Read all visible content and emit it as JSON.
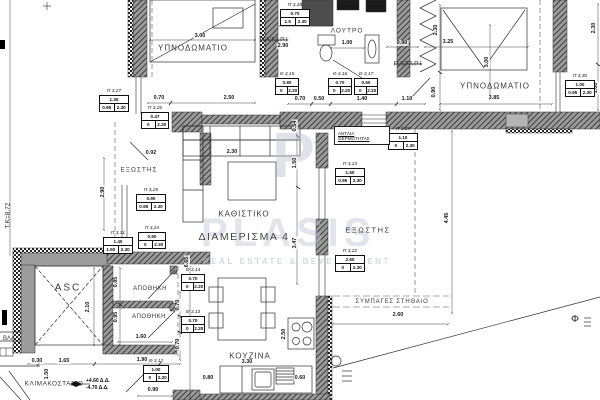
{
  "watermark": {
    "monogram": "P",
    "brand": "PLASIS",
    "tagline": "REAL ESTATE & DEVELOPMENT"
  },
  "unit": {
    "label": "ΔΙΑΜΕΡΙΣΜΑ 4"
  },
  "heatpump": {
    "line1": "ΑΝΤΛΙΑ",
    "line2": "ΘΕΡΜΟΤΗΤΑΣ"
  },
  "annotations": {
    "level": "Τ.Κ=8.72",
    "elev_up": "+4.60 Δ.Δ.",
    "elev_dn": "-4.70 Δ.Δ.",
    "phi": "Φ"
  },
  "labels": [
    {
      "t": "ΥΠΝΟΔΩΜΑΤΙΟ",
      "x": 193,
      "y": 48,
      "s": 8,
      "ls": 1
    },
    {
      "t": "ΥΠΝΟΔΩΜΑΤΙΟ",
      "x": 495,
      "y": 86,
      "s": 8,
      "ls": 1
    },
    {
      "t": "ΠΑΤΑΡΙ",
      "x": 274,
      "y": 40,
      "s": 6.5,
      "ls": 1,
      "strike": true
    },
    {
      "t": "ΠΑΤΑΡΙ",
      "x": 408,
      "y": 64,
      "s": 6.5,
      "ls": 1,
      "strike": true
    },
    {
      "t": "ΛΟΥΤΡΟ",
      "x": 347,
      "y": 31,
      "s": 6.5,
      "ls": 1
    },
    {
      "t": "ΚΑΘΙΣΤΙΚΟ",
      "x": 244,
      "y": 214,
      "s": 8,
      "ls": 1
    },
    {
      "t": "ΚΟΥΖΙΝΑ",
      "x": 250,
      "y": 356,
      "s": 8,
      "ls": 1
    },
    {
      "t": "ΕΞΩΣΤΗΣ",
      "x": 139,
      "y": 170,
      "s": 6.5,
      "ls": 1
    },
    {
      "t": "ΕΞΩΣΤΗΣ",
      "x": 368,
      "y": 230,
      "s": 7.5,
      "ls": 1.5
    },
    {
      "t": "ΑΠΟΘΗΚΗ",
      "x": 150,
      "y": 289,
      "s": 6,
      "ls": 0.5
    },
    {
      "t": "ΑΠΟΘΗΚΗ",
      "x": 149,
      "y": 317,
      "s": 6,
      "ls": 0.5
    },
    {
      "t": "ASC",
      "x": 68,
      "y": 288,
      "s": 10,
      "ls": 2
    },
    {
      "t": "ΚΛΙΜΑΚΟΣΤΑΣΙΟ",
      "x": 54,
      "y": 384,
      "s": 6.5,
      "ls": 0.5
    },
    {
      "t": "ΣΥΜΠΑΓΕΣ ΣΤΗΘΑΙΟ",
      "x": 392,
      "y": 302,
      "s": 6,
      "ls": 0.8
    },
    {
      "t": "ΒΛΑ",
      "x": 9,
      "y": 339,
      "s": 6,
      "ls": 0
    }
  ],
  "dims": [
    {
      "v": "3.00",
      "x": 200,
      "y": 36
    },
    {
      "v": "0.70",
      "x": 159,
      "y": 98
    },
    {
      "v": "2.50",
      "x": 229,
      "y": 98
    },
    {
      "v": "2.90",
      "x": 283,
      "y": 46
    },
    {
      "v": "1.00",
      "x": 347,
      "y": 43
    },
    {
      "v": "0.90",
      "x": 402,
      "y": 43
    },
    {
      "v": "0.70",
      "x": 300,
      "y": 99
    },
    {
      "v": "0.50",
      "x": 319,
      "y": 99
    },
    {
      "v": "1.40",
      "x": 362,
      "y": 99
    },
    {
      "v": "1.10",
      "x": 407,
      "y": 99
    },
    {
      "v": "0.90",
      "x": 434,
      "y": 92,
      "r": 1
    },
    {
      "v": "2.30",
      "x": 436,
      "y": 30,
      "r": 1
    },
    {
      "v": "3.25",
      "x": 448,
      "y": 42
    },
    {
      "v": "3.00",
      "x": 487,
      "y": 62,
      "r": 1
    },
    {
      "v": "2.30",
      "x": 594,
      "y": 28,
      "r": 1
    },
    {
      "v": "1.00",
      "x": 596,
      "y": 88,
      "r": 1
    },
    {
      "v": "3.85",
      "x": 494,
      "y": 98
    },
    {
      "v": "0.92",
      "x": 151,
      "y": 153
    },
    {
      "v": "2.30",
      "x": 232,
      "y": 152
    },
    {
      "v": "2.90",
      "x": 103,
      "y": 192,
      "r": 1
    },
    {
      "v": "0.54",
      "x": 295,
      "y": 126,
      "r": 1
    },
    {
      "v": "1.50",
      "x": 295,
      "y": 163,
      "r": 1
    },
    {
      "v": "3.47",
      "x": 295,
      "y": 243,
      "r": 1
    },
    {
      "v": "6.65",
      "x": 187,
      "y": 262,
      "r": 1
    },
    {
      "v": "4.45",
      "x": 447,
      "y": 218,
      "r": 1
    },
    {
      "v": "2.60",
      "x": 398,
      "y": 315
    },
    {
      "v": "3.30",
      "x": 247,
      "y": 362
    },
    {
      "v": "0.60",
      "x": 300,
      "y": 378
    },
    {
      "v": "0.80",
      "x": 208,
      "y": 378
    },
    {
      "v": "2.50",
      "x": 284,
      "y": 334,
      "r": 1
    },
    {
      "v": "0.30",
      "x": 37,
      "y": 361
    },
    {
      "v": "1.65",
      "x": 64,
      "y": 361
    },
    {
      "v": "1.90",
      "x": 142,
      "y": 360
    },
    {
      "v": "1.50",
      "x": 47,
      "y": 374,
      "r": 1
    },
    {
      "v": "2.10",
      "x": 88,
      "y": 307,
      "r": 1
    },
    {
      "v": "0.85",
      "x": 116,
      "y": 282,
      "r": 1
    },
    {
      "v": "0.95",
      "x": 116,
      "y": 317,
      "r": 1
    },
    {
      "v": "1.60",
      "x": 141,
      "y": 337
    },
    {
      "v": "0.70",
      "x": 178,
      "y": 305,
      "r": 1
    },
    {
      "v": "0.70",
      "x": 178,
      "y": 344,
      "r": 1
    },
    {
      "v": "0.90",
      "x": 153,
      "y": 390
    }
  ],
  "openings": [
    {
      "id": "Π 3,28",
      "w": "0.70",
      "s": "1.5",
      "h": "2.30",
      "x": 280,
      "y": 3,
      "wd": 30
    },
    {
      "id": "Π 3,27",
      "w": "1.30",
      "s": "0.95",
      "h": "2.30",
      "x": 99,
      "y": 89,
      "wd": 30
    },
    {
      "id": "Π 3,26",
      "w": "0.47",
      "s": "0",
      "h": "2.30",
      "x": 141,
      "y": 106,
      "wd": 28
    },
    {
      "id": "Π 3,25",
      "w": "0.90",
      "s": "0.95",
      "h": "2.30",
      "x": 136,
      "y": 188,
      "wd": 30
    },
    {
      "id": "Π 3,24",
      "w": "0.60",
      "s": "0",
      "h": "2.30",
      "x": 138,
      "y": 226,
      "wd": 28
    },
    {
      "id": "Π 3,31",
      "w": "1.40",
      "s": "1.50",
      "h": "2.30",
      "x": 103,
      "y": 231,
      "wd": 30
    },
    {
      "id": "Π 3,30",
      "w": "1.00",
      "s": "0.95",
      "h": "2.30",
      "x": 565,
      "y": 74,
      "wd": 30
    },
    {
      "id": "Π 3,29",
      "w": "1.10",
      "s": "0",
      "h": "2.30",
      "x": 388,
      "y": 127,
      "wd": 30
    },
    {
      "id": "Π 3,23",
      "w": "1.50",
      "s": "0.95",
      "h": "2.30",
      "x": 335,
      "y": 162,
      "wd": 30
    },
    {
      "id": "Π 3,22",
      "w": "2.60",
      "s": "0",
      "h": "2.30",
      "x": 335,
      "y": 249,
      "wd": 30
    },
    {
      "id": "Θ 3,15",
      "w": "0.80",
      "s": "0",
      "h": "2.20",
      "x": 275,
      "y": 72,
      "wd": 24
    },
    {
      "id": "Θ 3,16",
      "w": "0.70",
      "s": "0",
      "h": "2.20",
      "x": 328,
      "y": 72,
      "wd": 24
    },
    {
      "id": "Θ 3,17",
      "w": "0.60",
      "s": "0",
      "h": "2.20",
      "x": 354,
      "y": 72,
      "wd": 24
    },
    {
      "id": "Θ 3,14",
      "w": "0.70",
      "s": "0",
      "h": "2.20",
      "x": 181,
      "y": 268,
      "wd": 24
    },
    {
      "id": "Θ 3,13",
      "w": "0.70",
      "s": "0",
      "h": "2.20",
      "x": 181,
      "y": 310,
      "wd": 24
    },
    {
      "id": "Θ 3,12",
      "w": "1.00",
      "s": "0",
      "h": "2.20",
      "x": 143,
      "y": 359,
      "wd": 26
    }
  ],
  "colors": {
    "wall": "#9b9b9b",
    "wall_hatch": "#3c3c3c",
    "line": "#2f2f2f",
    "gray_wall": "#9c9c9c",
    "watermark": "#b9c0ce"
  }
}
